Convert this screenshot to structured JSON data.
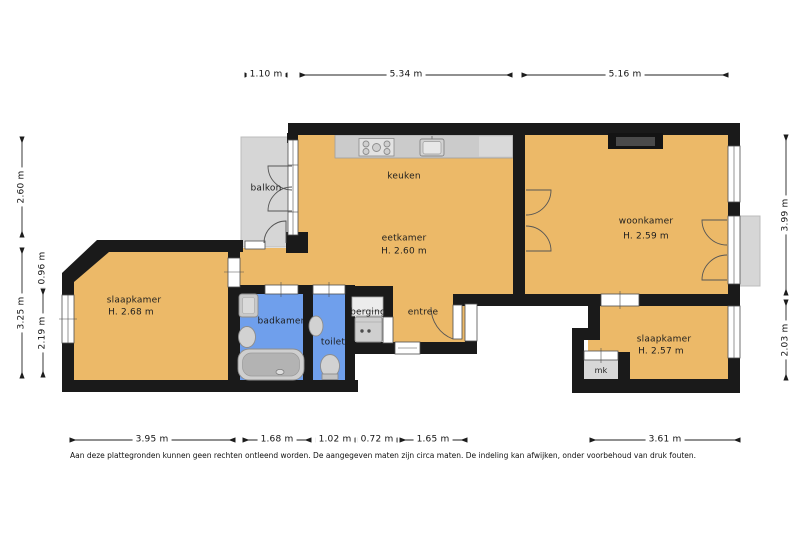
{
  "plan": {
    "rooms": {
      "balkon": {
        "label": "balkon"
      },
      "keuken": {
        "label": "keuken"
      },
      "eetkamer": {
        "label": "eetkamer",
        "height": "H. 2.60 m"
      },
      "woonkamer": {
        "label": "woonkamer",
        "height": "H. 2.59 m"
      },
      "slaapkamer_links": {
        "label": "slaapkamer",
        "height": "H. 2.68 m"
      },
      "badkamer": {
        "label": "badkamer"
      },
      "toilet": {
        "label": "toilet"
      },
      "berging": {
        "label": "berging"
      },
      "entree": {
        "label": "entree"
      },
      "slaapkamer_rechts": {
        "label": "slaapkamer",
        "height": "H. 2.57 m"
      },
      "mk": {
        "label": "mk"
      }
    },
    "dimensions": {
      "top": [
        "1.10 m",
        "5.34 m",
        "5.16 m"
      ],
      "bottom": [
        "3.95 m",
        "1.68 m",
        "1.02 m",
        "0.72 m",
        "1.65 m",
        "3.61 m"
      ],
      "left_outer": [
        "2.60 m",
        "3.25 m"
      ],
      "left_inner": [
        "0.96 m",
        "2.19 m"
      ],
      "right": [
        "3.99 m",
        "2.03 m"
      ]
    },
    "disclaimer": "Aan deze plattegronden kunnen geen rechten ontleend worden. De aangegeven maten zijn circa maten. De indeling kan afwijken, onder voorbehoud van druk fouten.",
    "colors": {
      "floor": "#ecb968",
      "wet_room": "#6f9fec",
      "balcony": "#d6d6d6",
      "wall": "#1a1a1a"
    }
  }
}
